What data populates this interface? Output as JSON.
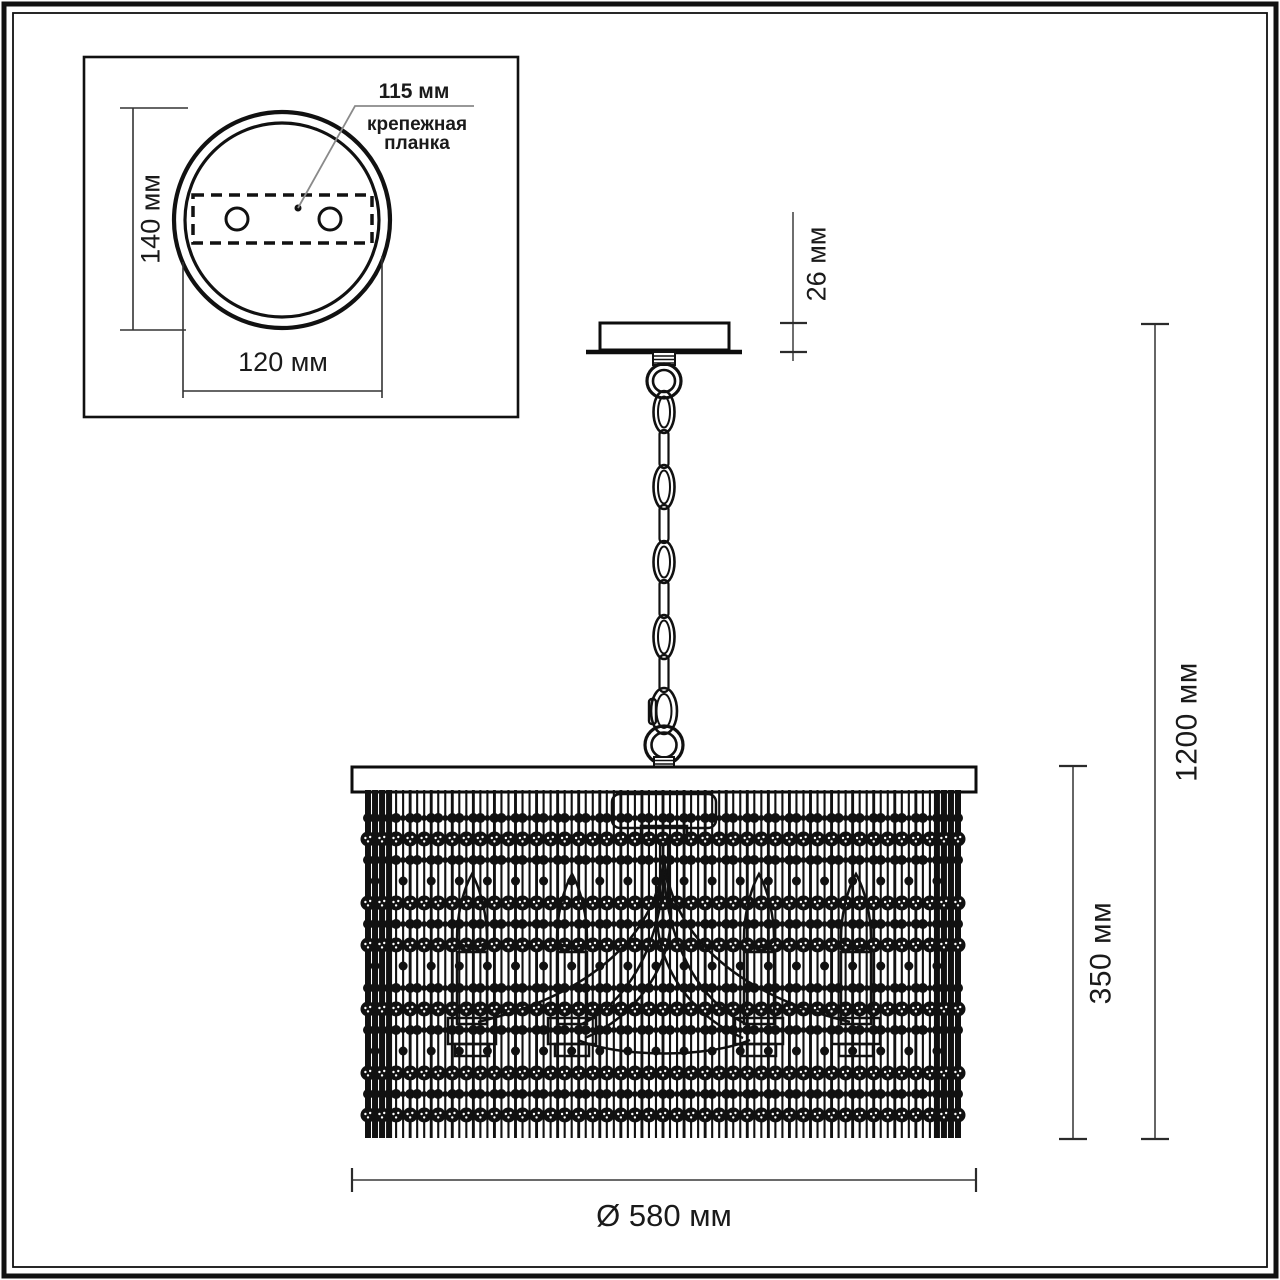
{
  "inset": {
    "height_dim": "140 мм",
    "width_dim": "120 мм",
    "callout_value": "115 мм",
    "callout_caption_line1": "крепежная",
    "callout_caption_line2": "планка"
  },
  "main": {
    "canopy_height_dim": "26 мм",
    "overall_height_dim": "1200 мм",
    "shade_height_dim": "350 мм",
    "diameter_dim": "Ø 580 мм"
  },
  "colors": {
    "ink": "#111111",
    "dim_line": "#555555",
    "tick": "#2b2b2b",
    "leader": "#8a8a8a",
    "background": "#ffffff"
  }
}
